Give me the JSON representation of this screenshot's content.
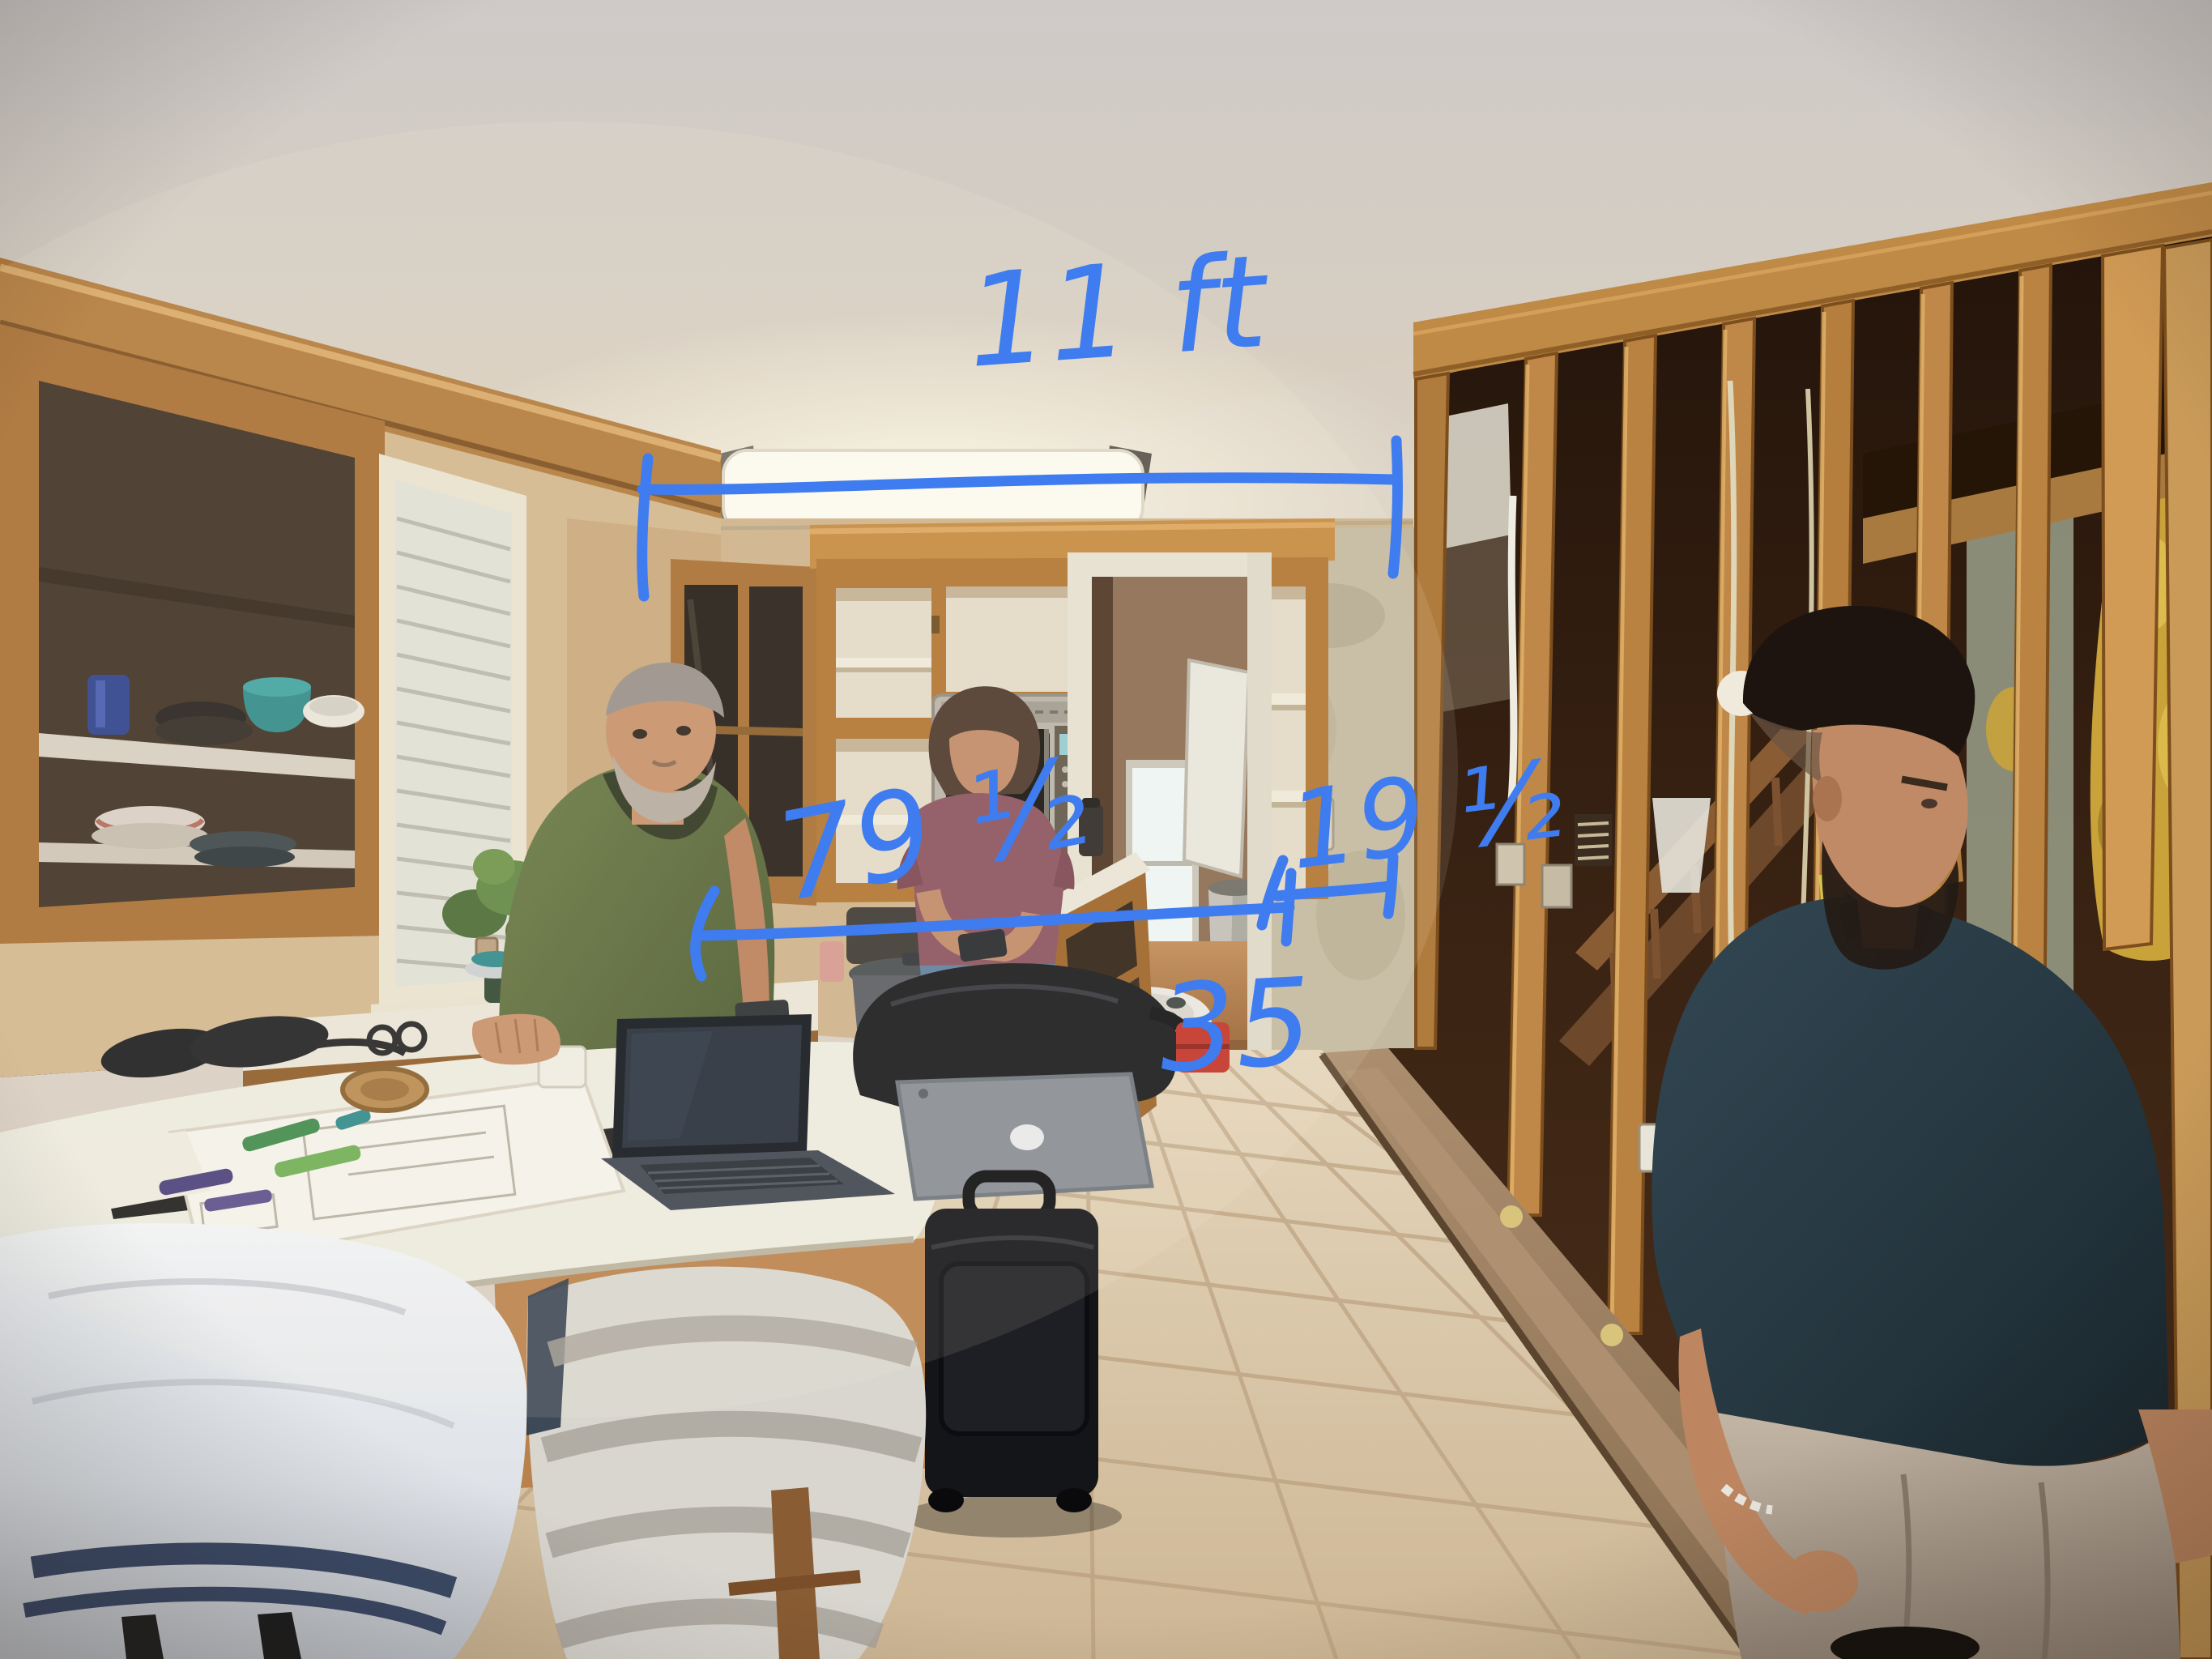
{
  "scene": {
    "description": "Kitchen mid-renovation: oak cabinets with doors removed, stove with pots, microwave, island covered with laptop and plans, exposed wall studs with staircase behind on the right, tile floor, three people discussing the remodel",
    "people": [
      "older man in green shirt leaning on island",
      "woman in maroon shirt checking her phone by the stove",
      "man in navy polo walking past the exposed studs"
    ]
  },
  "annotations": {
    "ink_color": "#3e7cf0",
    "ceiling_span_label": "11 ft",
    "counter_span_label": "79 ½",
    "wall_span_label": "19 ½",
    "opening_width_label": "35"
  },
  "palette": {
    "cabinet_wood": "#b0742f",
    "wall_plaster": "#d5bc95",
    "tile_floor": "#dccaae",
    "stud_lumber": "#c08848",
    "counter_top": "#eceadf",
    "towel_white": "#eef0f2",
    "towel_gray": "#d9d6d0",
    "shirt_green": "#5c6d3f",
    "shirt_maroon": "#8a525e",
    "shirt_navy": "#263843",
    "hall_floor": "#a9713f"
  }
}
